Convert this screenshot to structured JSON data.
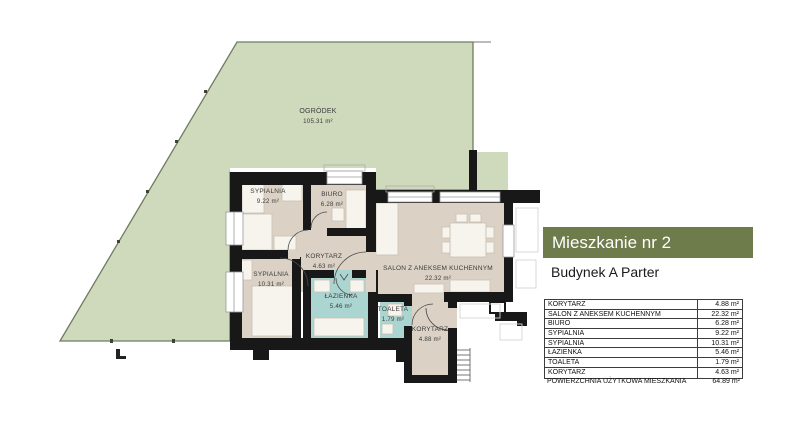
{
  "plan": {
    "garden": {
      "label": "OGRÓDEK",
      "area": "105.31 m²"
    },
    "rooms": [
      {
        "id": "sypialnia-1",
        "label": "SYPIALNIA",
        "area": "9.22 m²"
      },
      {
        "id": "biuro",
        "label": "BIURO",
        "area": "6.28 m²"
      },
      {
        "id": "korytarz-1",
        "label": "KORYTARZ",
        "area": "4.63 m²"
      },
      {
        "id": "sypialnia-2",
        "label": "SYPIALNIA",
        "area": "10.31 m²"
      },
      {
        "id": "lazienka",
        "label": "ŁAZIENKA",
        "area": "5.46 m²"
      },
      {
        "id": "toaleta",
        "label": "TOALETA",
        "area": "1.79 m²"
      },
      {
        "id": "salon",
        "label": "SALON Z ANEKSEM KUCHENNYM",
        "area": "22.32 m²"
      },
      {
        "id": "korytarz-2",
        "label": "KORYTARZ",
        "area": "4.88 m²"
      }
    ]
  },
  "panel": {
    "title": "Mieszkanie nr 2",
    "subtitle": "Budynek A Parter",
    "table": {
      "rows": [
        {
          "name": "KORYTARZ",
          "area": "4.88 m²"
        },
        {
          "name": "SALON Z ANEKSEM KUCHENNYM",
          "area": "22.32 m²"
        },
        {
          "name": "BIURO",
          "area": "6.28 m²"
        },
        {
          "name": "SYPIALNIA",
          "area": "9.22 m²"
        },
        {
          "name": "SYPIALNIA",
          "area": "10.31 m²"
        },
        {
          "name": "ŁAZIENKA",
          "area": "5.46 m²"
        },
        {
          "name": "TOALETA",
          "area": "1.79 m²"
        },
        {
          "name": "KORYTARZ",
          "area": "4.63 m²"
        }
      ],
      "total": {
        "name": "POWIERZCHNIA UŻYTKOWA MIESZKANIA",
        "area": "64.89 m²"
      }
    }
  },
  "colors": {
    "accent_olive": "#6e7b4a",
    "garden_green": "#cfd9bc",
    "floor_beige": "#dbd2c5",
    "bath_teal": "#abd5d1",
    "wall_black": "#181818"
  }
}
